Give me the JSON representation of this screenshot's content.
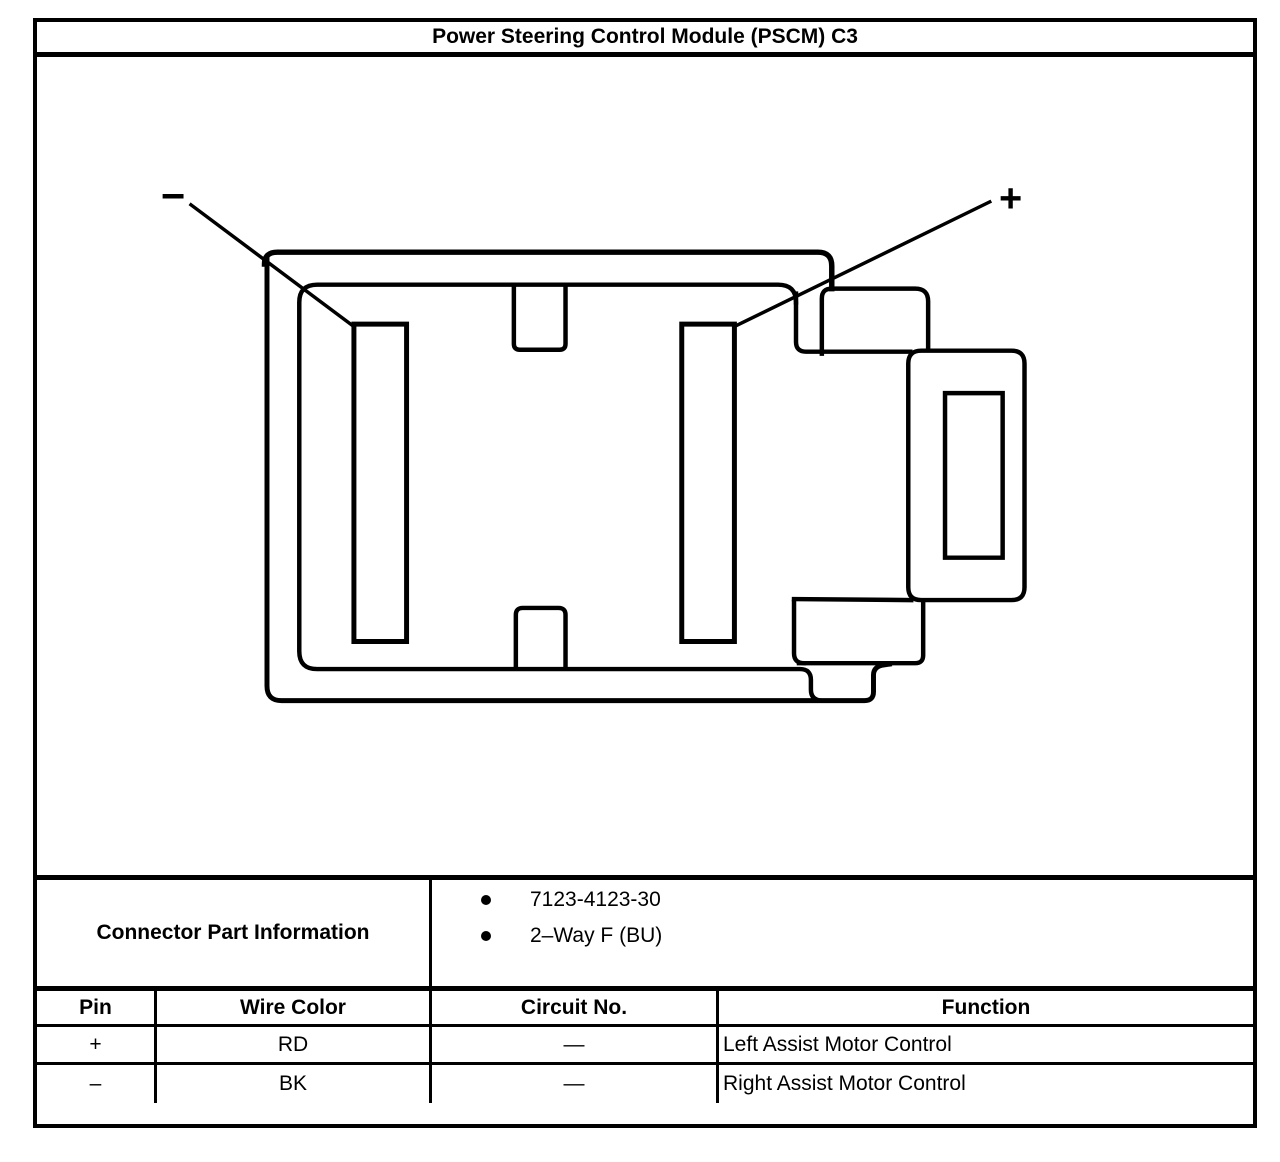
{
  "title": "Power Steering Control Module (PSCM) C3",
  "diagram": {
    "description": "2-way connector face view line drawing",
    "minus_label": "−",
    "plus_label": "+"
  },
  "connector_info": {
    "label": "Connector Part Information",
    "items": [
      "7123-4123-30",
      "2–Way F (BU)"
    ]
  },
  "table": {
    "headers": [
      "Pin",
      "Wire Color",
      "Circuit No.",
      "Function"
    ],
    "rows": [
      {
        "pin": "+",
        "wire_color": "RD",
        "circuit_no": "—",
        "function": "Left Assist Motor Control"
      },
      {
        "pin": "–",
        "wire_color": "BK",
        "circuit_no": "—",
        "function": "Right Assist Motor Control"
      }
    ]
  },
  "colors": {
    "line": "#000000",
    "background": "#ffffff"
  }
}
